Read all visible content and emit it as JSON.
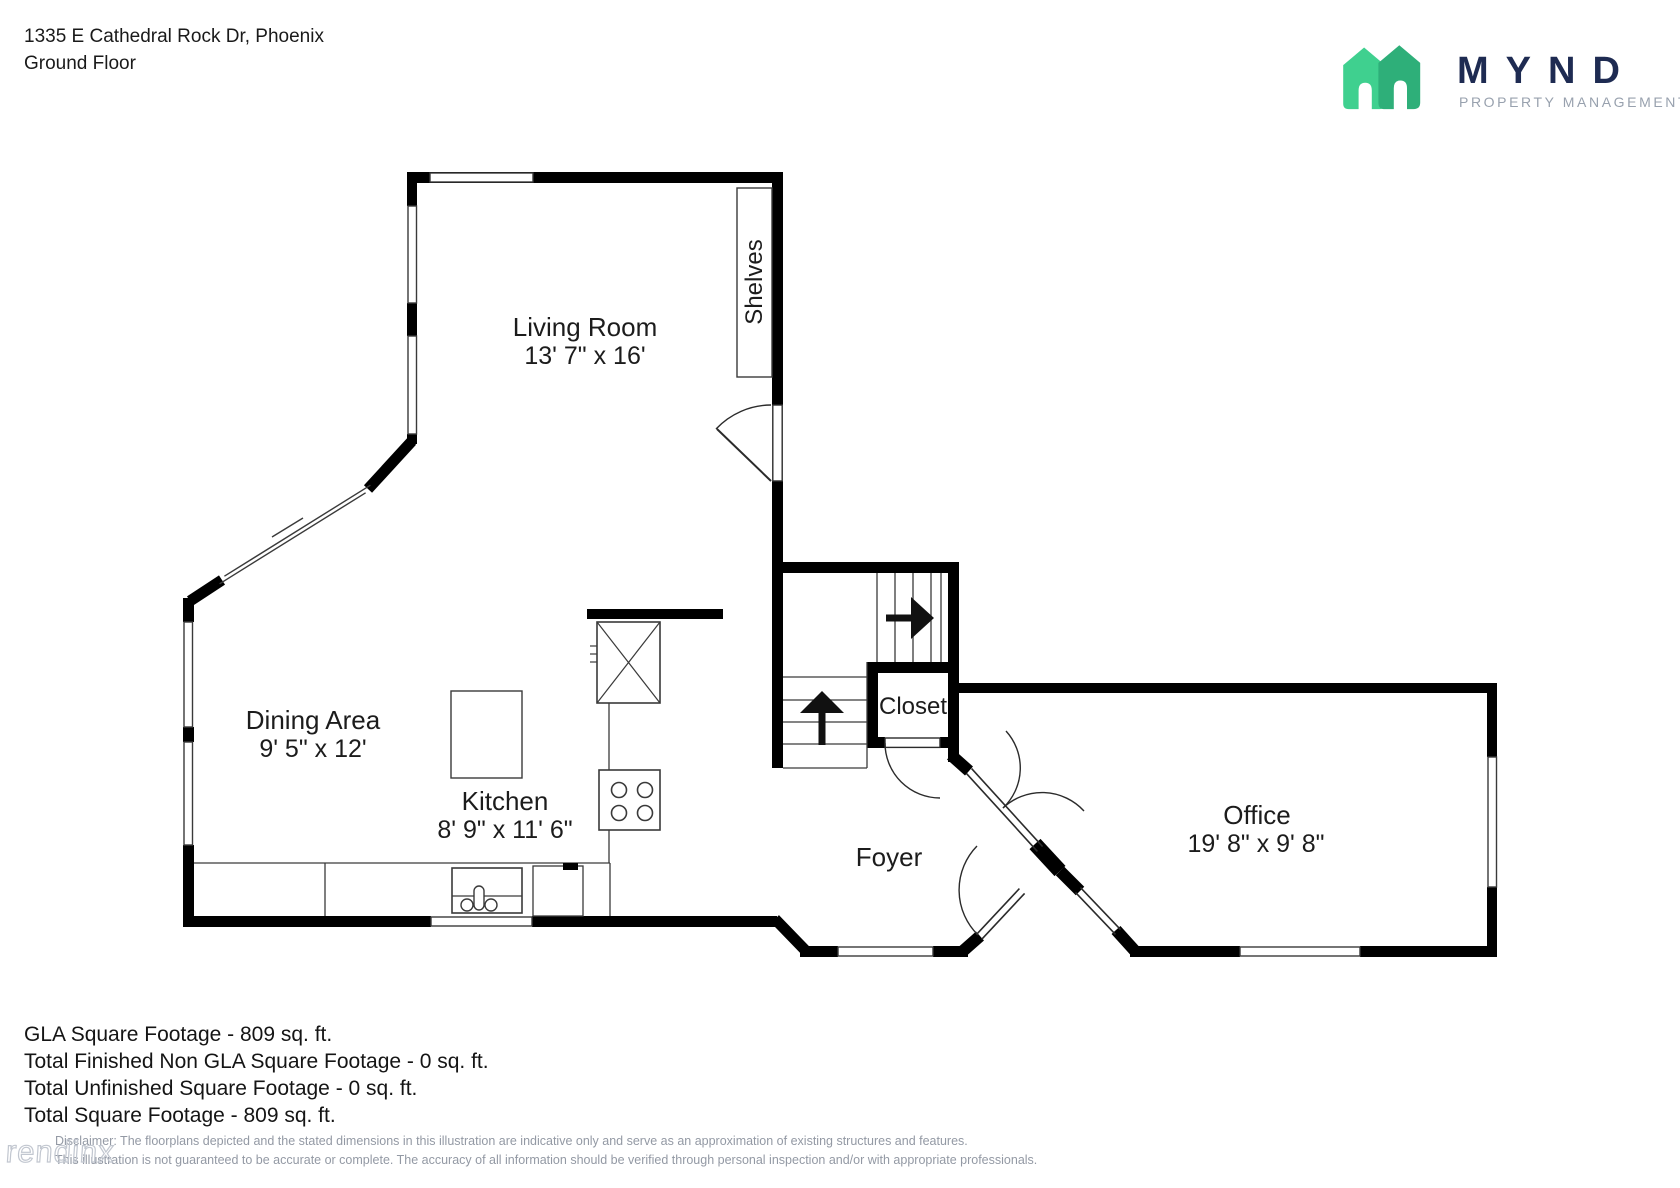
{
  "header": {
    "address": "1335 E Cathedral Rock Dr, Phoenix",
    "floor": "Ground Floor"
  },
  "logo": {
    "word": "MYND",
    "tagline": "PROPERTY MANAGEMENT",
    "house_light_color": "#3fd08f",
    "house_dark_color": "#2eaf79",
    "word_color": "#1e2b52",
    "tagline_color": "#98a1ae"
  },
  "rooms": {
    "living": {
      "label": "Living Room",
      "dims": "13' 7\" x 16'"
    },
    "dining": {
      "label": "Dining Area",
      "dims": "9' 5\" x 12'"
    },
    "kitchen": {
      "label": "Kitchen",
      "dims": "8' 9\" x 11' 6\""
    },
    "office": {
      "label": "Office",
      "dims": "19' 8\" x 9' 8\""
    },
    "foyer": {
      "label": "Foyer"
    },
    "closet": {
      "label": "Closet"
    },
    "shelves": {
      "label": "Shelves"
    }
  },
  "summary": {
    "lines": [
      "GLA Square Footage - 809 sq. ft.",
      "Total Finished Non GLA Square Footage - 0 sq. ft.",
      "Total Unfinished Square Footage - 0 sq. ft.",
      "Total Square Footage - 809 sq. ft."
    ]
  },
  "disclaimer": {
    "line1": "Disclaimer: The floorplans depicted and the stated dimensions in this illustration are indicative only and serve as an approximation of existing structures and features.",
    "line2": "This illustration is not guaranteed to be accurate or complete. The accuracy of all information should be verified through personal inspection and/or with appropriate professionals."
  },
  "watermark": "rendinx",
  "colors": {
    "wall": "#000000",
    "thin_line": "#3a3a3a"
  }
}
